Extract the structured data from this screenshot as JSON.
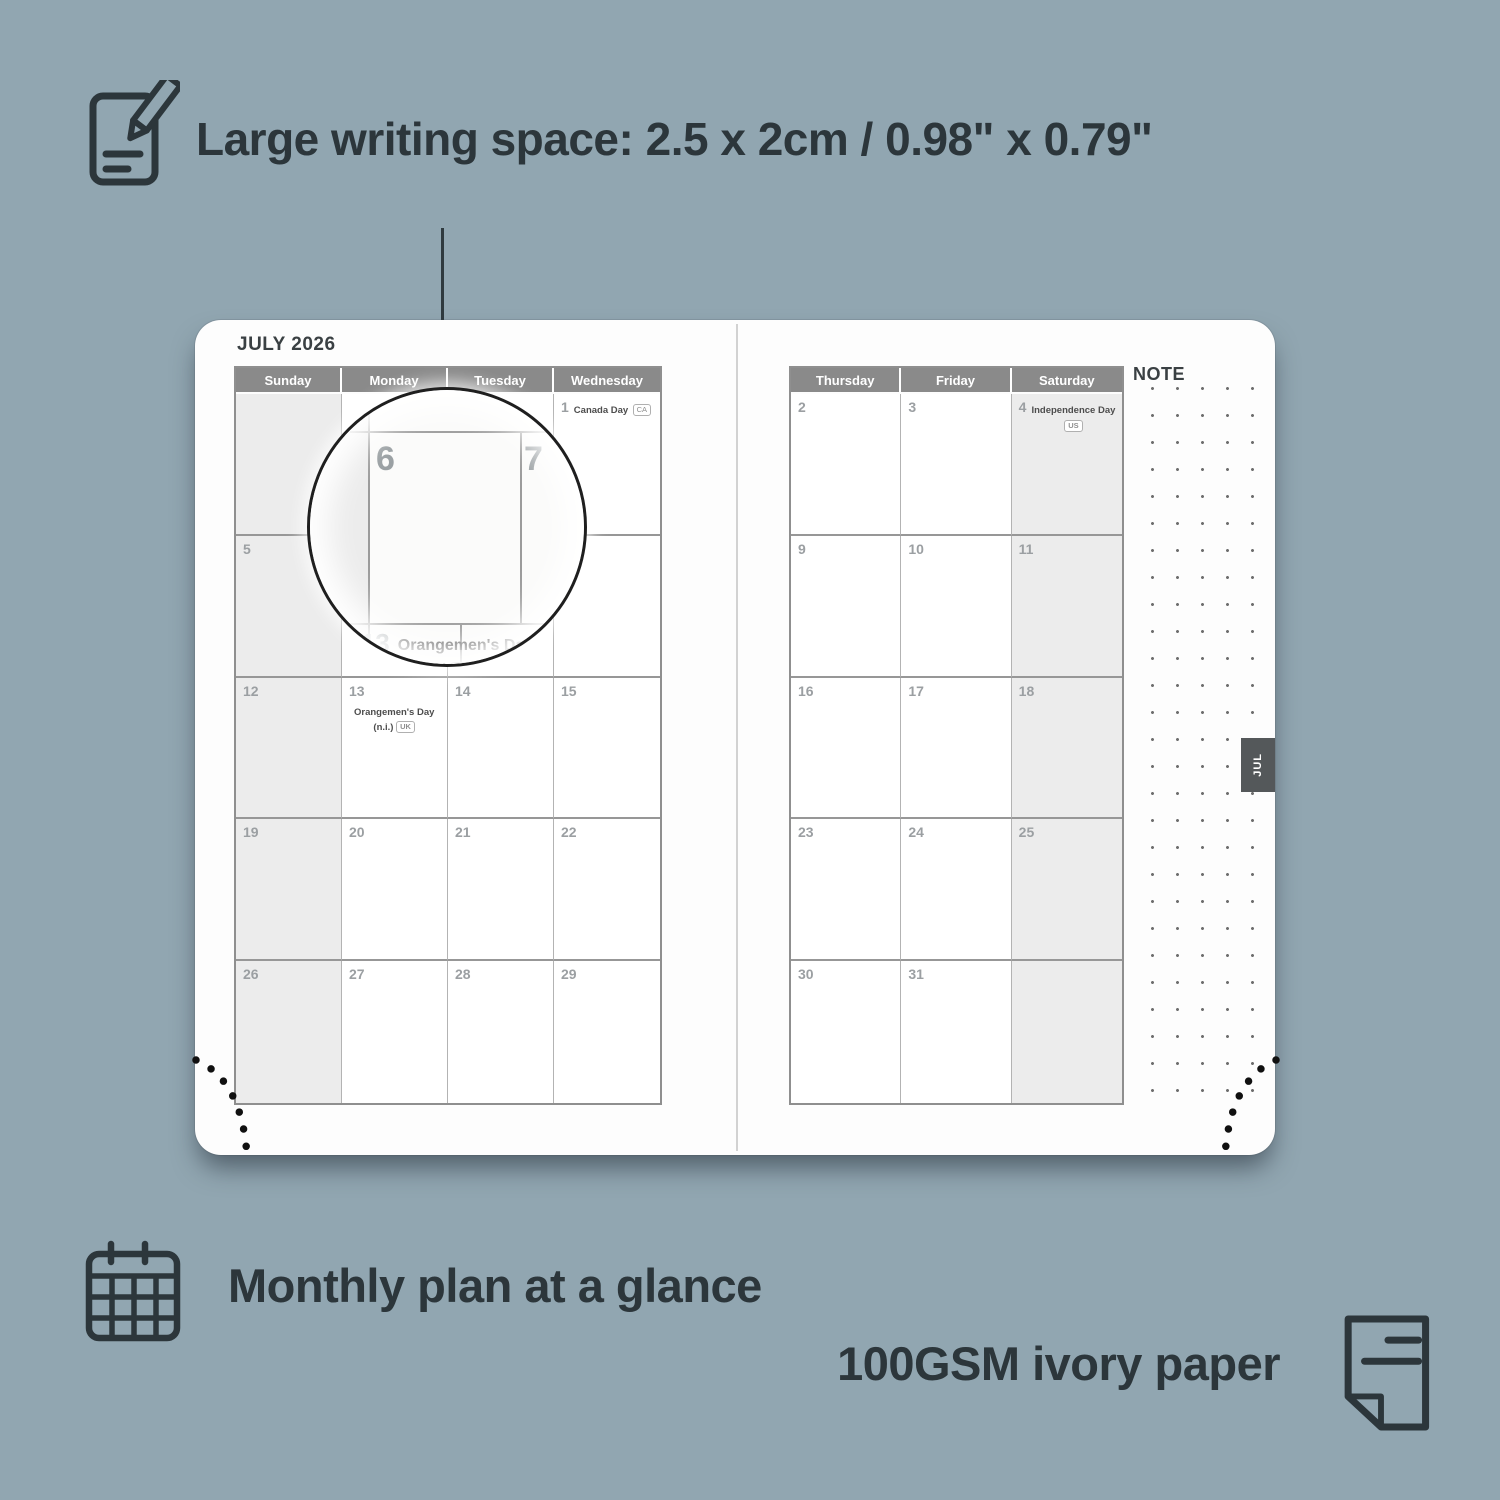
{
  "colors": {
    "background": "#91a6b1",
    "ink": "#2c363b",
    "header_bar": "#8a8a8a",
    "shaded_cell": "#ececec",
    "tab": "#54585a",
    "page": "#fdfdfd"
  },
  "feature_top": {
    "label": "Large writing space: 2.5 x 2cm / 0.98\" x 0.79\"",
    "icon": "notepad-pencil-icon"
  },
  "features_bottom": {
    "monthly": {
      "label": "Monthly plan at a glance",
      "icon": "calendar-grid-icon"
    },
    "paper": {
      "label": "100GSM ivory paper",
      "icon": "paper-sheet-icon"
    }
  },
  "planner": {
    "month_title": "JULY 2026",
    "note_label": "NOTE",
    "tab_label": "JUL",
    "left": {
      "headers": [
        "Sunday",
        "Monday",
        "Tuesday",
        "Wednesday"
      ],
      "shaded_col": 0,
      "weeks": [
        [
          {},
          {},
          {},
          {
            "day": "1",
            "holiday": "Canada Day",
            "badge": "CA",
            "badge_inline": true
          }
        ],
        [
          {
            "day": "5"
          },
          {
            "day": "6"
          },
          {
            "day": "7"
          },
          {
            "day": "8"
          }
        ],
        [
          {
            "day": "12"
          },
          {
            "day": "13",
            "holiday": "Orangemen's Day",
            "line2": "(n.i.)",
            "badge": "UK"
          },
          {
            "day": "14"
          },
          {
            "day": "15"
          }
        ],
        [
          {
            "day": "19"
          },
          {
            "day": "20"
          },
          {
            "day": "21"
          },
          {
            "day": "22"
          }
        ],
        [
          {
            "day": "26"
          },
          {
            "day": "27"
          },
          {
            "day": "28"
          },
          {
            "day": "29"
          }
        ]
      ]
    },
    "right": {
      "headers": [
        "Thursday",
        "Friday",
        "Saturday"
      ],
      "shaded_col": 2,
      "weeks": [
        [
          {
            "day": "2"
          },
          {
            "day": "3"
          },
          {
            "day": "4",
            "holiday": "Independence Day",
            "badge": "US",
            "badge_below": true
          }
        ],
        [
          {
            "day": "9"
          },
          {
            "day": "10"
          },
          {
            "day": "11"
          }
        ],
        [
          {
            "day": "16"
          },
          {
            "day": "17"
          },
          {
            "day": "18"
          }
        ],
        [
          {
            "day": "23"
          },
          {
            "day": "24"
          },
          {
            "day": "25"
          }
        ],
        [
          {
            "day": "30"
          },
          {
            "day": "31"
          },
          {}
        ]
      ]
    }
  },
  "magnifier": {
    "day_left": "6",
    "day_right": "7",
    "below_day": "13",
    "below_holiday": "Orangemen's Day",
    "below_line2": "(n.i.)",
    "below_badge": "UK"
  }
}
